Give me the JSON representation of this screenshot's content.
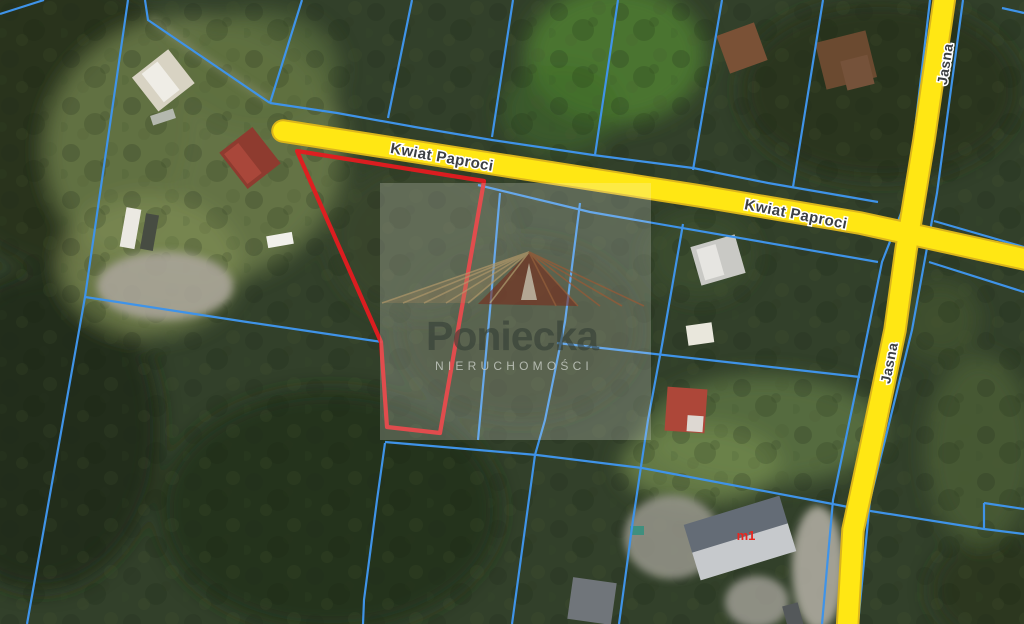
{
  "map": {
    "type": "satellite-cadastral-view",
    "road_labels": {
      "kwiat_paproci_a": "Kwiat Paproci",
      "kwiat_paproci_b": "Kwiat Paproci",
      "jasna_a": "Jasna",
      "jasna_b": "Jasna"
    },
    "parcel_label": "m1",
    "watermark": {
      "brand": "Poniecka",
      "subtitle": "NIERUCHOMOŚCI"
    },
    "colors": {
      "road_fill": "#ffe714",
      "road_border": "#dbb51c",
      "cadastral_line": "#3f93e8",
      "highlight_parcel": "#e51b20",
      "parcel_label_color": "#e8261f",
      "road_label_color": "#3d4043"
    }
  }
}
